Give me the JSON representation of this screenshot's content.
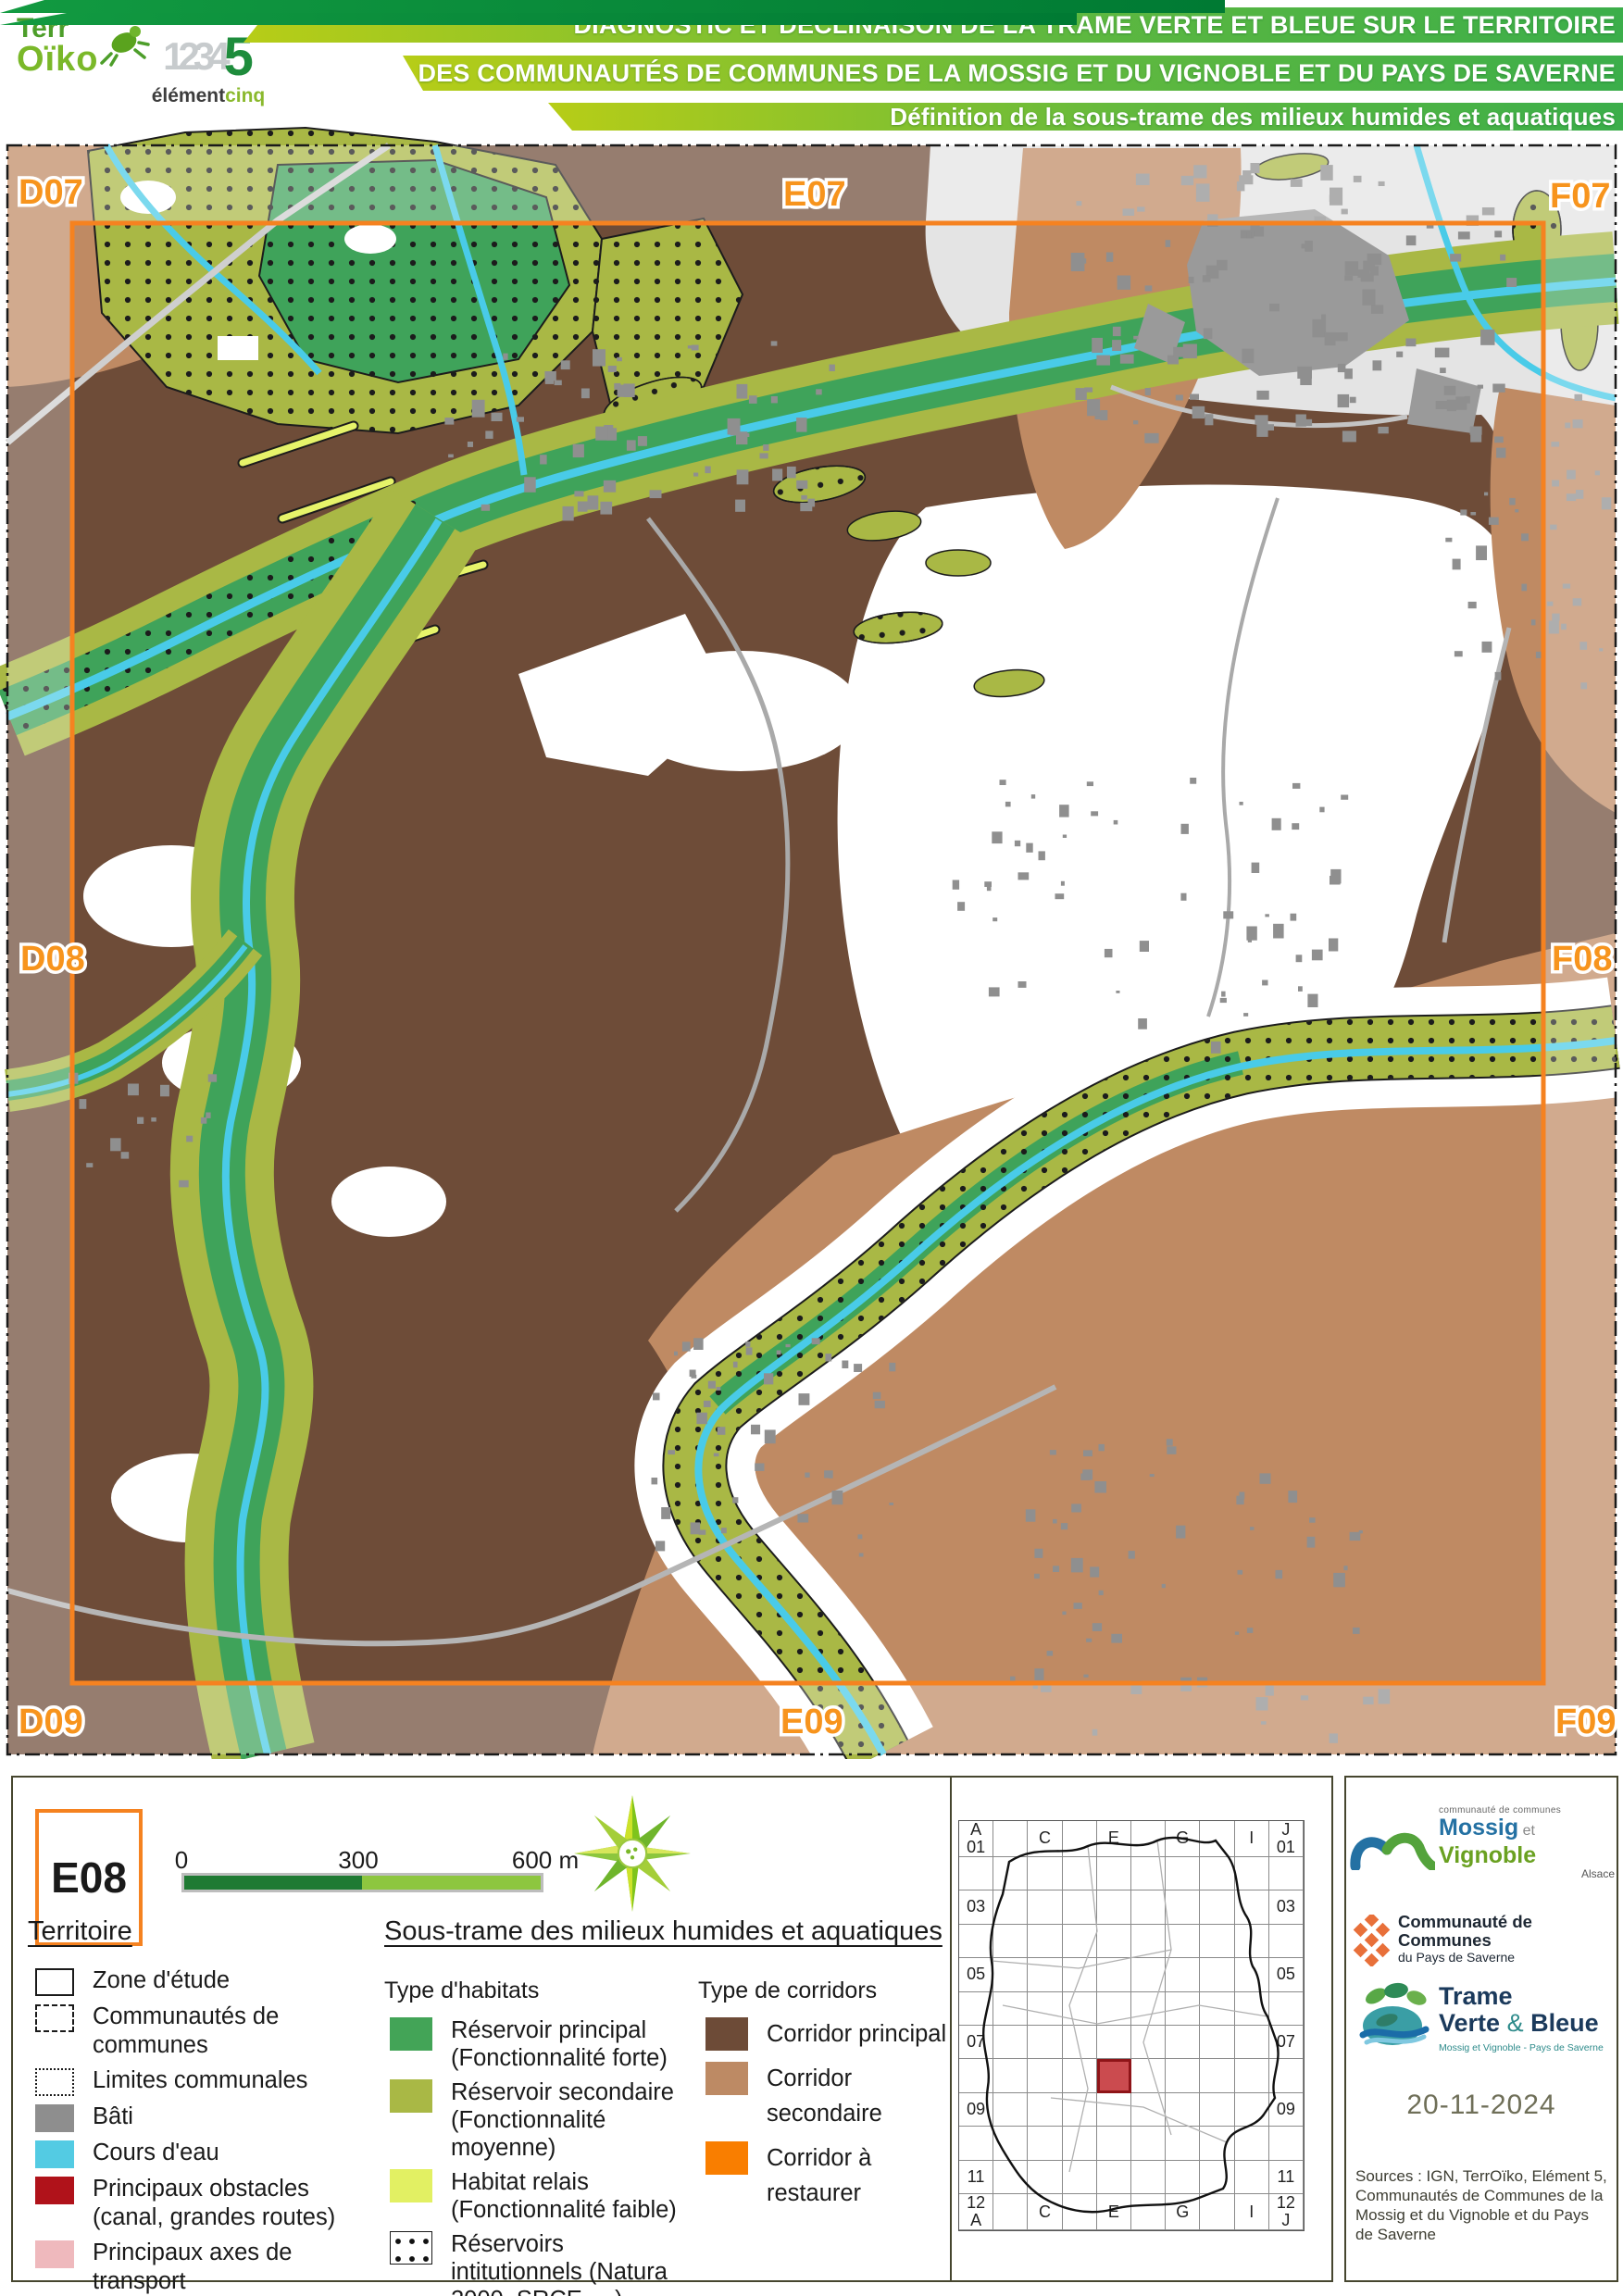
{
  "header": {
    "terroiko_line1": "Terr",
    "terroiko_line2": "Oïko",
    "element5_digits": "1234",
    "element5_five": "5",
    "element5_name1": "élément",
    "element5_name2": "cinq",
    "banner_line1": "DIAGNOSTIC ET DÉCLINAISON DE LA TRAME VERTE ET BLEUE SUR LE TERRITOIRE",
    "banner_line2": "DES COMMUNAUTÉS DE COMMUNES DE LA MOSSIG ET DU VIGNOBLE ET DU PAYS DE SAVERNE",
    "banner_line3": "Définition de la sous-trame des milieux humides et aquatiques"
  },
  "map": {
    "grid_labels": {
      "top_left": "D07",
      "top_center": "E07",
      "top_right": "F07",
      "mid_left": "D08",
      "mid_right": "F08",
      "bottom_left": "D09",
      "bottom_center": "E09",
      "bottom_right": "F09"
    },
    "frame_color": "#f58220",
    "label_color": "#f7941d"
  },
  "panel": {
    "sheet_label": "E08",
    "scale": {
      "t0": "0",
      "t300": "300",
      "t600": "600 m"
    },
    "territoire": {
      "title": "Territoire",
      "items": [
        {
          "label": "Zone d'étude",
          "type": "sw-zone"
        },
        {
          "label": "Communautés de communes",
          "type": "sw-dashed"
        },
        {
          "label": "Limites communales",
          "type": "sw-dotted"
        },
        {
          "label": "Bâti",
          "type": "sw-solid",
          "color": "#8e8e8e"
        },
        {
          "label": "Cours d'eau",
          "type": "sw-solid",
          "color": "#53cbe3"
        },
        {
          "label": "Principaux obstacles (canal, grandes routes)",
          "type": "sw-solid",
          "color": "#b0121a"
        },
        {
          "label": "Principaux axes de transport",
          "type": "sw-solid",
          "color": "#efb9bd"
        }
      ]
    },
    "soustrame": {
      "title": "Sous-trame des milieux humides et aquatiques",
      "habitats_title": "Type d'habitats",
      "habitats": [
        {
          "label": "Réservoir principal (Fonctionnalité forte)",
          "type": "sw-solid",
          "color": "#43a457"
        },
        {
          "label": "Réservoir secondaire (Fonctionnalité moyenne)",
          "type": "sw-solid",
          "color": "#a9b845"
        },
        {
          "label": "Habitat relais (Fonctionnalité faible)",
          "type": "sw-solid",
          "color": "#e2f063"
        },
        {
          "label": "Réservoirs intitutionnels (Natura 2000, SRCE, ...)",
          "type": "sw-dots"
        }
      ],
      "corridors_title": "Type de corridors",
      "corridors": [
        {
          "label": "Corridor principal",
          "type": "sw-solid",
          "color": "#6d4b37"
        },
        {
          "label": "Corridor secondaire",
          "type": "sw-solid",
          "color": "#bd8a64"
        },
        {
          "label": "Corridor à restaurer",
          "type": "sw-solid",
          "color": "#f97e00"
        }
      ]
    }
  },
  "minimap": {
    "labels": {
      "0,0": "A\n01",
      "0,2": "C",
      "0,4": "E",
      "0,6": "G",
      "0,8": "I",
      "0,9": "J\n01",
      "2,0": "03",
      "2,9": "03",
      "4,0": "05",
      "4,9": "05",
      "6,0": "07",
      "6,9": "07",
      "8,0": "09",
      "8,9": "09",
      "10,0": "11",
      "10,9": "11",
      "11,0": "12\nA",
      "11,2": "C",
      "11,4": "E",
      "11,6": "G",
      "11,8": "I",
      "11,9": "12\nJ"
    },
    "highlight": {
      "row": 7,
      "col": 4
    },
    "highlight_color": "rgba(194,43,48,0.85)"
  },
  "logos": {
    "mossig": {
      "small": "communauté de communes",
      "name1": "Mossig",
      "et": " et ",
      "name2": "Vignoble",
      "region": "Alsace"
    },
    "saverne": {
      "line1": "Communauté de Communes",
      "line2": "du Pays de Saverne"
    },
    "tvb": {
      "line1": "Trame",
      "line2a": "Verte ",
      "amp": "& ",
      "line2b": "Bleue",
      "subtitle": "Mossig et Vignoble - Pays de Saverne"
    }
  },
  "credits": {
    "date": "20-11-2024",
    "sources": "Sources : IGN, TerrOïko, Elément 5, Communautés de Communes de la Mossig et du Vignoble et du Pays de Saverne"
  }
}
